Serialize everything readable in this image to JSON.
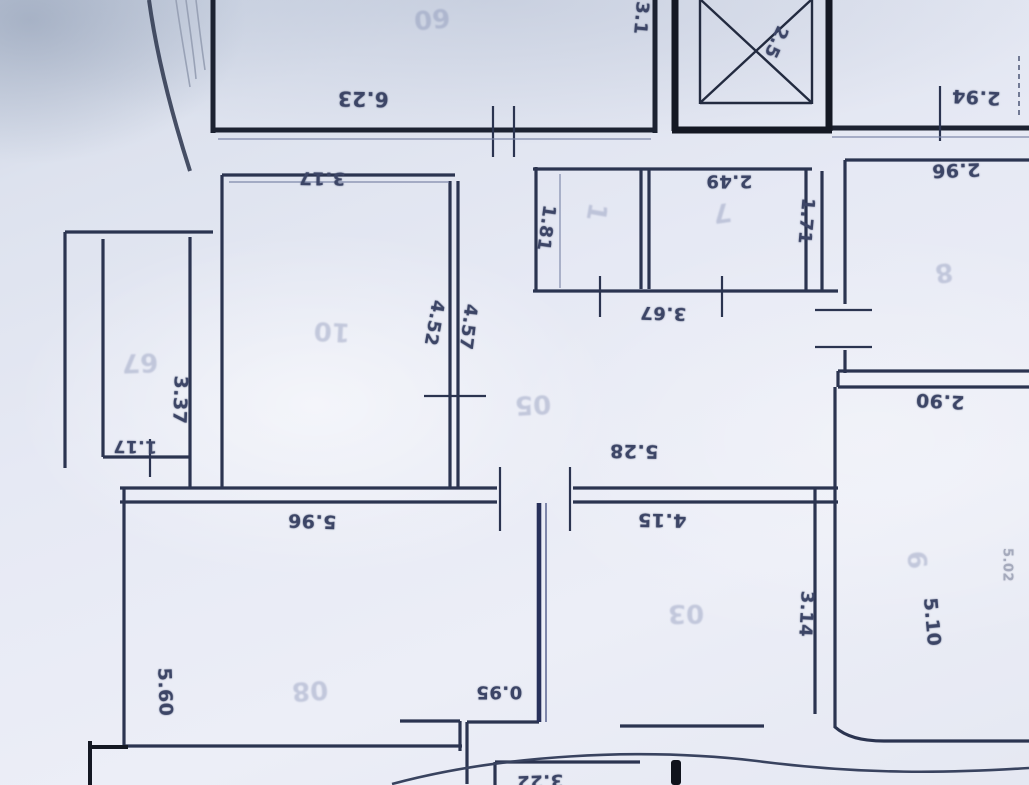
{
  "plan": {
    "colors": {
      "paper": "#e6e9f4",
      "ink": "#2b3450",
      "heavy_ink": "#141823",
      "feature_wall": "#27305a",
      "pencil": "#7f8ab0",
      "ink_text": "#3c4566"
    },
    "dimension_labels": [
      {
        "text": "6.23",
        "x": 363,
        "y": 99,
        "r": 181,
        "size": 20
      },
      {
        "text": "3.17",
        "x": 322,
        "y": 178,
        "r": 181,
        "size": 18
      },
      {
        "text": "3.1",
        "x": 641,
        "y": 18,
        "r": 95,
        "size": 18
      },
      {
        "text": "2.5",
        "x": 776,
        "y": 42,
        "r": 115,
        "size": 18
      },
      {
        "text": "2.94",
        "x": 976,
        "y": 97,
        "r": 183,
        "size": 19
      },
      {
        "text": "2.96",
        "x": 956,
        "y": 170,
        "r": 178,
        "size": 19
      },
      {
        "text": "1.81",
        "x": 546,
        "y": 228,
        "r": 98,
        "size": 18
      },
      {
        "text": "2.49",
        "x": 729,
        "y": 181,
        "r": 180,
        "size": 18
      },
      {
        "text": "1.71",
        "x": 806,
        "y": 221,
        "r": 95,
        "size": 18
      },
      {
        "text": "3.67",
        "x": 663,
        "y": 313,
        "r": 182,
        "size": 18
      },
      {
        "text": "4.52",
        "x": 434,
        "y": 323,
        "r": 100,
        "size": 18
      },
      {
        "text": "4.57",
        "x": 468,
        "y": 327,
        "r": 97,
        "size": 18
      },
      {
        "text": "3.37",
        "x": 180,
        "y": 400,
        "r": 92,
        "size": 19
      },
      {
        "text": "1.17",
        "x": 135,
        "y": 446,
        "r": 181,
        "size": 17
      },
      {
        "text": "5.28",
        "x": 634,
        "y": 451,
        "r": 181,
        "size": 19
      },
      {
        "text": "2.90",
        "x": 940,
        "y": 401,
        "r": 183,
        "size": 19
      },
      {
        "text": "5.96",
        "x": 312,
        "y": 521,
        "r": 182,
        "size": 19
      },
      {
        "text": "4.15",
        "x": 662,
        "y": 520,
        "r": 181,
        "size": 19
      },
      {
        "text": "3.14",
        "x": 806,
        "y": 614,
        "r": 93,
        "size": 18
      },
      {
        "text": "5.10",
        "x": 932,
        "y": 622,
        "r": 85,
        "size": 19
      },
      {
        "text": "5.60",
        "x": 165,
        "y": 692,
        "r": 88,
        "size": 19
      },
      {
        "text": "0.95",
        "x": 499,
        "y": 692,
        "r": 180,
        "size": 18
      },
      {
        "text": "3.22",
        "x": 540,
        "y": 781,
        "r": 178,
        "size": 18
      },
      {
        "text": "5.02",
        "x": 1007,
        "y": 565,
        "r": 90,
        "size": 13,
        "faint": true
      }
    ],
    "room_marks": [
      {
        "text": "60",
        "x": 432,
        "y": 18,
        "r": 175
      },
      {
        "text": "10",
        "x": 332,
        "y": 331,
        "r": 183
      },
      {
        "text": "05",
        "x": 533,
        "y": 404,
        "r": 177
      },
      {
        "text": "03",
        "x": 686,
        "y": 613,
        "r": 179
      },
      {
        "text": "8",
        "x": 944,
        "y": 272,
        "r": 172
      },
      {
        "text": "6",
        "x": 916,
        "y": 560,
        "r": 85
      },
      {
        "text": "1",
        "x": 596,
        "y": 212,
        "r": 100
      },
      {
        "text": "7",
        "x": 722,
        "y": 212,
        "r": 172
      },
      {
        "text": "67",
        "x": 140,
        "y": 362,
        "r": 178
      },
      {
        "text": "08",
        "x": 310,
        "y": 690,
        "r": 176
      }
    ]
  }
}
